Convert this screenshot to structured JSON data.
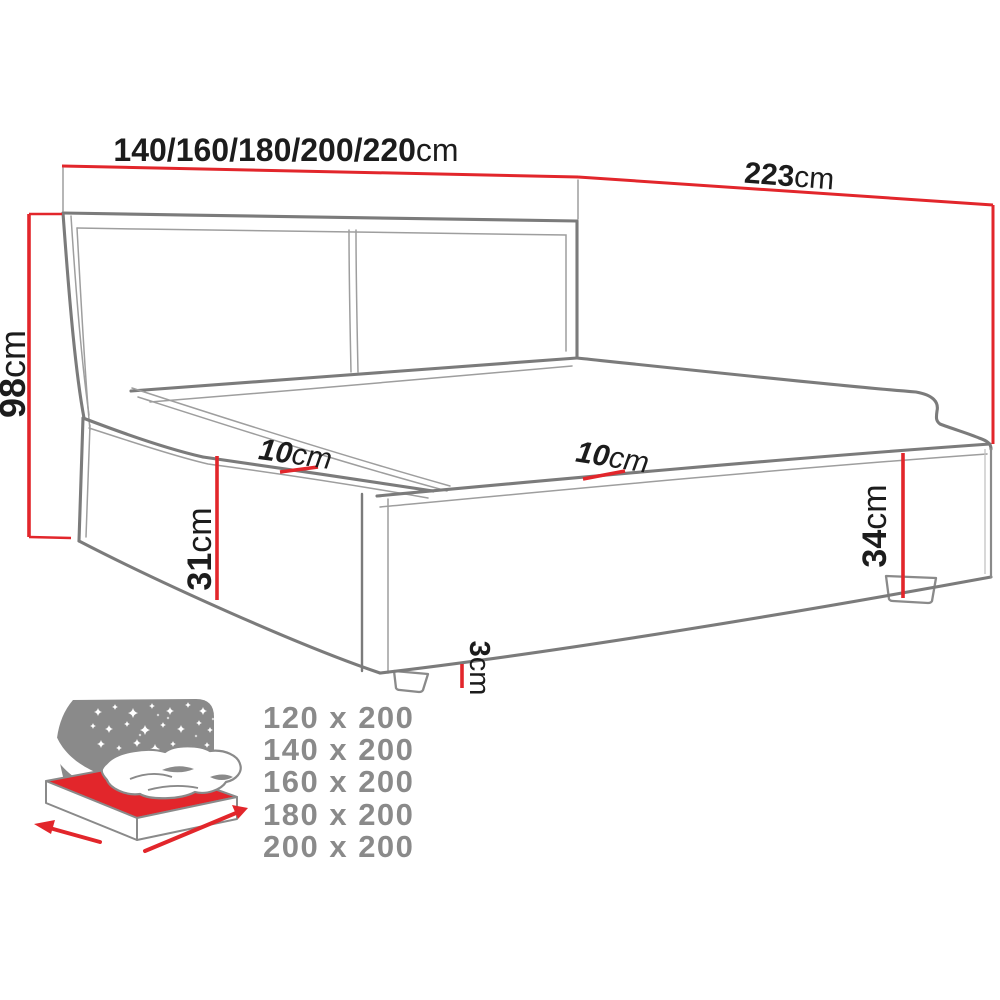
{
  "colors": {
    "dimension_red": "#e2262b",
    "line_gray": "#7b7b7b",
    "thin_gray": "#9e9e9e",
    "text_black": "#1c1c1c",
    "muted_gray": "#8a8a8a"
  },
  "diagram": {
    "labels": {
      "width_options": {
        "value": "140/160/180/200/220",
        "unit": "cm"
      },
      "length": {
        "value": "223",
        "unit": "cm"
      },
      "headboard_height": {
        "value": "98",
        "unit": "cm"
      },
      "front_panel_height": {
        "value": "31",
        "unit": "cm"
      },
      "side_panel_height": {
        "value": "34",
        "unit": "cm"
      },
      "headboard_ledge_depth": {
        "value": "10",
        "unit": "cm"
      },
      "side_ledge_depth": {
        "value": "10",
        "unit": "cm"
      },
      "leg_height": {
        "value": "3",
        "unit": "cm"
      }
    }
  },
  "size_variants": {
    "items": [
      "120 x 200",
      "140 x 200",
      "160 x 200",
      "180 x 200",
      "200 x 200"
    ]
  }
}
